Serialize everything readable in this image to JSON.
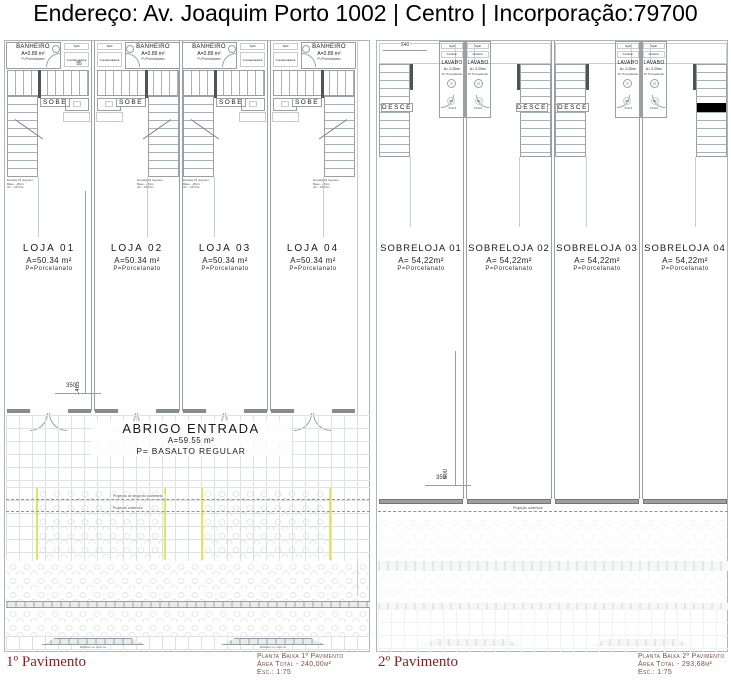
{
  "header": {
    "title": "Endereço: Av. Joaquim Porto 1002 | Centro | Incorporação:79700"
  },
  "colors": {
    "plan_name": "#8b2020",
    "caption": "#7b4f46",
    "boundary_marker": "#e4e460"
  },
  "left_plan": {
    "label": "1º Pavimento",
    "caption": {
      "l1": "Planta Baixa 1º Pavimento",
      "l2": "Área Total - 240,00m²",
      "l3": "Esc.: 1:75"
    },
    "bathroom": {
      "title": "BANHEIRO",
      "area": "A=2.89 m²",
      "floor": "P=Porcelanato"
    },
    "shaft": {
      "split": "Split",
      "condenser": "Condensadora"
    },
    "stair": {
      "label": "SOBE",
      "note1": "Escada 19 degraus",
      "note2": "Base - 28cm",
      "note3": "Alt. - 18,5cm"
    },
    "units": [
      {
        "name": "LOJA 01",
        "area": "A=50.34 m²",
        "floor": "P=Porcelanato"
      },
      {
        "name": "LOJA 02",
        "area": "A=50.34 m²",
        "floor": "P=Porcelanato"
      },
      {
        "name": "LOJA 03",
        "area": "A=50.34 m²",
        "floor": "P=Porcelanato"
      },
      {
        "name": "LOJA 04",
        "area": "A=50.34 m²",
        "floor": "P=Porcelanato"
      }
    ],
    "entry": {
      "title": "ABRIGO ENTRADA",
      "area": "A=59.55 m²",
      "floor": "P= BASALTO REGULAR"
    },
    "dims": {
      "top": "95",
      "depth": "1465",
      "front": "350"
    },
    "projections": {
      "second": "Projeção do segundo pavimento",
      "roof": "Projeção cobertura"
    },
    "curb_cut": "Rebaixo no meio fio"
  },
  "right_plan": {
    "label": "2º Pavimento",
    "caption": {
      "l1": "Planta Baixa 2º Pavimento",
      "l2": "Área Total - 293,68m²",
      "l3": "Esc.: 1:75"
    },
    "lavabo": {
      "title": "LAVABO",
      "area": "A= 2,20m²",
      "floor": "P= Porcelanato"
    },
    "shaft": {
      "split": "Split",
      "condenser": "Condens."
    },
    "stair": {
      "label": "DESCE"
    },
    "door": {
      "tag": "P0",
      "size": "70x210"
    },
    "units": [
      {
        "name": "SOBRELOJA 01",
        "area": "A= 54,22m²",
        "floor": "P=Porcelanato"
      },
      {
        "name": "SOBRELOJA 02",
        "area": "A= 54,22m²",
        "floor": "P=Porcelanato"
      },
      {
        "name": "SOBRELOJA 03",
        "area": "A= 54,22m²",
        "floor": "P=Porcelanato"
      },
      {
        "name": "SOBRELOJA 04",
        "area": "A= 54,22m²",
        "floor": "P=Porcelanato"
      }
    ],
    "dims": {
      "top": "240",
      "depth": "600",
      "front": "350"
    },
    "projections": {
      "roof": "Projeção cobertura"
    }
  }
}
